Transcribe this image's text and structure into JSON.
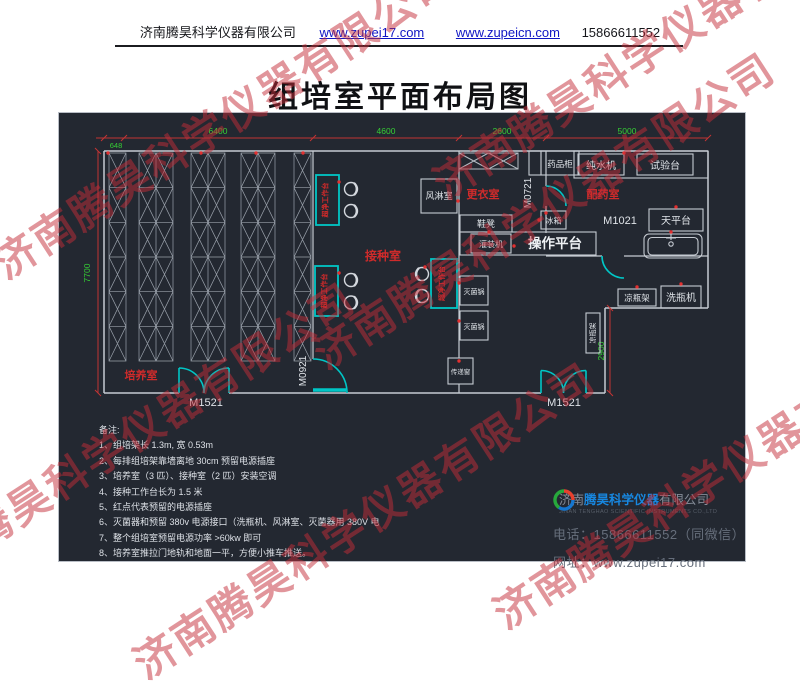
{
  "header": {
    "company": "济南腾昊科学仪器有限公司",
    "url1": "www.zupei17.com",
    "url2": "www.zupeicn.com",
    "phone": "15866611552"
  },
  "title": "组培室平面布局图",
  "plan": {
    "dims": {
      "d648": "648",
      "d6400": "6400",
      "d4600": "4600",
      "d2600": "2600",
      "d5000": "5000",
      "d7700": "7700",
      "d2900": "2900"
    },
    "rooms": {
      "culture": "培养室",
      "inoculation": "接种室",
      "changing": "更衣室",
      "dispensing": "配药室",
      "air_shower": "风淋室"
    },
    "doors": {
      "m1521": "M1521",
      "m0921": "M0921",
      "m0721": "M0721",
      "m1021": "M1021"
    },
    "equipment": {
      "clean_bench": "超净工作台",
      "medicine_cabinet": "药品柜",
      "water_purifier": "纯水机",
      "test_bench": "试验台",
      "fridge": "冰箱",
      "shoe_bench": "鞋凳",
      "filling_machine": "灌装机",
      "work_platform": "操作平台",
      "balance_table": "天平台",
      "sterilizer": "灭菌锅",
      "pass_window": "传递窗",
      "bottle_rack": "凉瓶架",
      "bottle_washer": "洗瓶机"
    }
  },
  "notes": {
    "title": "备注:",
    "items": [
      "1、组培架长 1.3m, 宽 0.53m",
      "2、每排组培架靠墙离地 30cm 预留电源插座",
      "3、培养室（3 匹）、接种室（2 匹）安装空调",
      "4、接种工作台长为 1.5 米",
      "5、红点代表预留的电源插座",
      "6、灭菌器和预留 380v 电源接口（洗瓶机、风淋室、灭菌器用 380V 电",
      "7、整个组培室预留电源功率 >60kw 即可",
      "8、培养室推拉门地轨和地面一平，方便小推车推送。"
    ]
  },
  "footer": {
    "brand_prefix": "济南",
    "brand": "腾昊科学仪器",
    "brand_suffix": "有限公司",
    "company_en": "JINAN TENGHAO SCIENTIFIC INSTRUMENTS CO.,LTD",
    "phone_label": "电话：",
    "phone": "15866611552（同微信）",
    "web_label": "网址：",
    "web": "www.zupei17.com"
  },
  "watermark": "济南腾昊科学仪器有限公司"
}
